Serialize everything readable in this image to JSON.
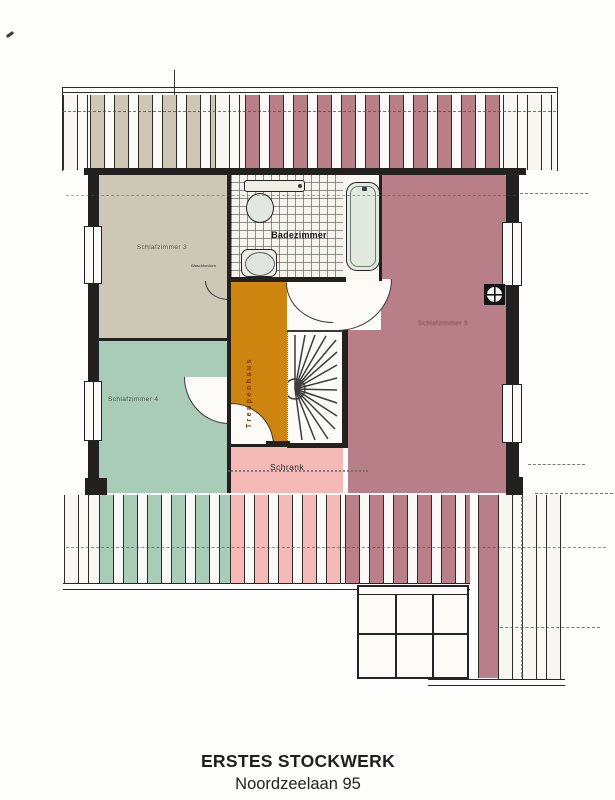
{
  "plan": {
    "title": "ERSTES STOCKWERK",
    "address": "Noordzeelaan 95",
    "rooms": {
      "schlafzimmer3": "Schlafzimmer 3",
      "schlafzimmer4": "Schlafzimmer 4",
      "schlafzimmer5": "Schlafzimmer 5",
      "badezimmer": "Badezimmer",
      "treppenhaus": "Treppenhaus",
      "schrank": "Schrank",
      "basin_note": "Waschbecken"
    },
    "colors": {
      "bedroom3_beige": "#cdc7b5",
      "bedroom4_green": "#a9ccb9",
      "bedroom5_mauve": "#b97f88",
      "hall_orange": "#cd850f",
      "closet_pink": "#f5bab5",
      "bath_tile": "#f5f3ec",
      "wall_black": "#222120",
      "paper_white": "#fdfdfb"
    }
  }
}
